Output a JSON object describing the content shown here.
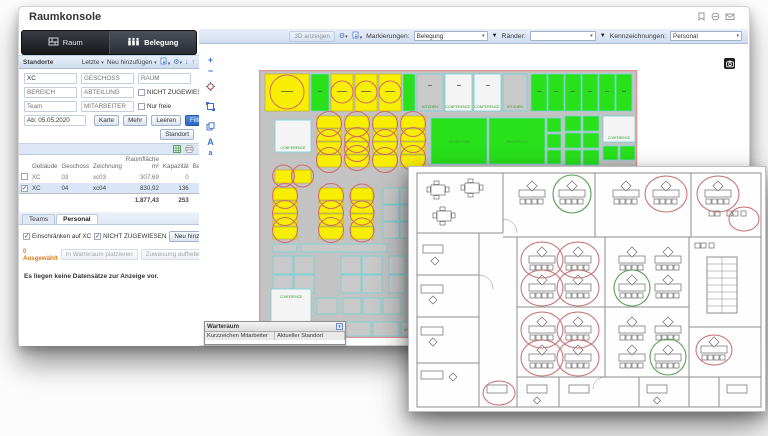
{
  "app": {
    "title": "Raumkonsole"
  },
  "colors": {
    "accent-blue": "#3b6fc9",
    "toolbar-top": "#e9effa",
    "toolbar-bot": "#cfdcee",
    "panel-border": "#aabdd5",
    "selected-row": "#d8e6f8",
    "primary-btn": "#2f66c4",
    "warn-orange": "#e07a1f",
    "room-yellow": "#f8ee00",
    "room-green": "#28e11b",
    "room-gray": "#c9c9c9",
    "room-white": "#f4f4f4",
    "floor-gray": "#c3c3c3",
    "room-stroke": "#74d4d4",
    "circle-red": "#d46a6a",
    "circle-green": "#5fae5f",
    "plan-border": "#e79090",
    "label-green": "#2f9e2f"
  },
  "icons": [
    "bookmark-icon",
    "print-icon",
    "mail-icon",
    "gear-icon",
    "export-icon",
    "arrow-down-icon",
    "arrow-up-icon",
    "excel-icon",
    "printer-icon",
    "zoom-in-icon",
    "zoom-out-icon",
    "center-target-icon",
    "fit-view-icon",
    "copy-view-icon",
    "font-increase-icon",
    "font-decrease-icon",
    "camera-icon",
    "minimize-icon",
    "raum-tab-icon",
    "belegung-tab-icon",
    "filter-funnel-icon"
  ],
  "left_panel": {
    "tabs": {
      "raum": "Raum",
      "belegung": "Belegung"
    },
    "standorte": {
      "title": "Standorte",
      "recent": "Letzte",
      "add": "Neu hinzufügen"
    },
    "form": {
      "building_value": "XC",
      "geschoss_ph": "GESCHOSS",
      "raum_ph": "RAUM",
      "bereich_ph": "BEREICH",
      "abteilung_ph": "ABTEILUNG",
      "team_ph": "Team",
      "mitarbeiter_ph": "MITARBEITER",
      "nicht_zugewiesen": "NICHT ZUGEWIESEN",
      "nur_freie": "Nur freie",
      "date_value": "Ab: 05.05.2020",
      "karte": "Karte",
      "mehr": "Mehr",
      "leeren": "Leeren",
      "filter": "Filter",
      "standort": "Standort"
    },
    "table": {
      "area_header_top": "Raumfläche",
      "cols": {
        "gebaeude": "Gebäude",
        "geschoss": "Geschoss",
        "zeichnung": "Zeichnung",
        "flaeche": "m²",
        "kapazitaet": "Kapazität",
        "belegung": "Bele"
      },
      "rows": [
        {
          "checked": false,
          "gebaeude": "XC",
          "geschoss": "03",
          "zeichnung": "xc03",
          "flaeche": "307,69",
          "kapazitaet": "0"
        },
        {
          "checked": true,
          "gebaeude": "XC",
          "geschoss": "04",
          "zeichnung": "xc04",
          "flaeche": "830,92",
          "kapazitaet": "136"
        }
      ],
      "sum_flaeche": "1.877,43",
      "sum_kapazitaet": "253"
    },
    "personal": {
      "tab_teams": "Teams",
      "tab_personal": "Personal",
      "einschraenken": "Einschränken auf XC",
      "nicht_zugewiesen": "NICHT ZUGEWIESEN",
      "neu": "Neu hinzufügen",
      "selected": "0 Ausgewählt",
      "warteraum_btn": "In Warteraum platzieren",
      "aufheben_btn": "Zuweisung aufheben",
      "empty": "Es liegen keine Datensätze zur Anzeige vor."
    }
  },
  "map": {
    "toolbar": {
      "d3": "3D anzeigen",
      "markierungen": "Markierungen:",
      "markierungen_value": "Belegung",
      "raender": "Ränder:",
      "raender_value": "",
      "kennzeichnungen": "Kennzeichnungen:",
      "kennzeichnungen_value": "Personal"
    },
    "labels": {
      "kitchen": "KITCHEN",
      "conference": "CONFERENCE",
      "reception": "RECEPTION"
    },
    "waitroom": {
      "title": "Warteraum",
      "col_kurzzeichen": "Kurzzeichen Mitarbeiter",
      "col_standort": "Aktueller Standort"
    }
  }
}
